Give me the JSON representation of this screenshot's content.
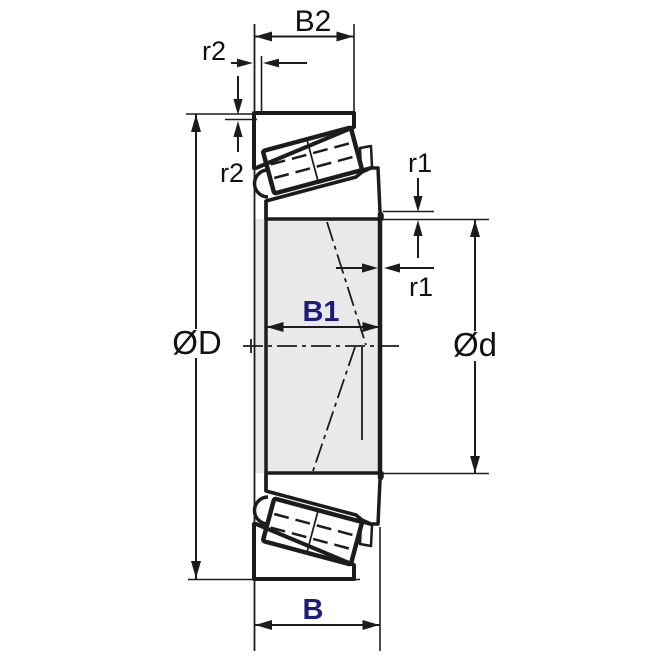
{
  "drawing": {
    "title": "Tapered roller bearing cross-section dimension diagram",
    "labels": {
      "b2": "B2",
      "r2_h": "r2",
      "r2_v": "r2",
      "r1_v": "r1",
      "r1_h": "r1",
      "b1": "B1",
      "od": "ØD",
      "d": "Ød",
      "b": "B"
    },
    "colors": {
      "background": "#ffffff",
      "section_fill": "#e9e9e9",
      "line": "#1c1c1c",
      "label": "#111111",
      "label_accent": "#1b1b7a"
    }
  }
}
